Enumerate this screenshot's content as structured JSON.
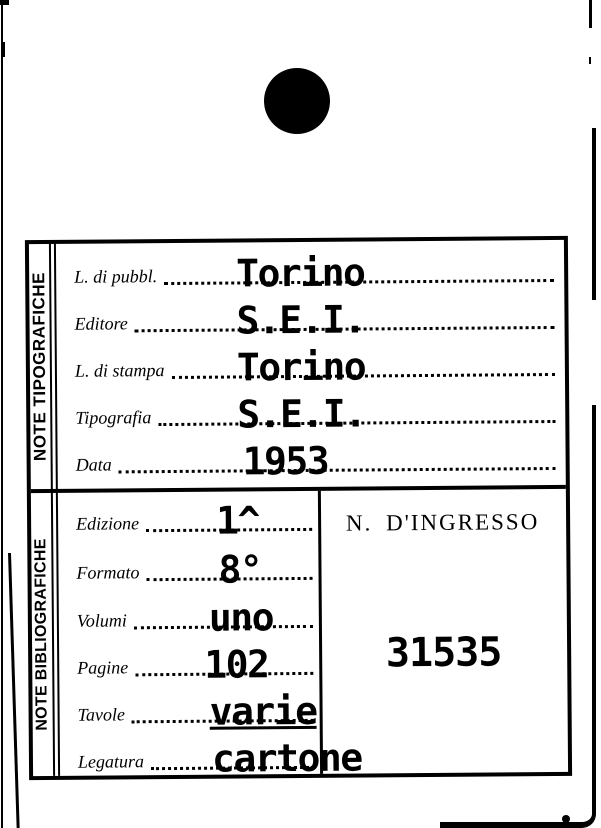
{
  "card": {
    "sections": [
      {
        "side_label": "NOTE TIPOGRAFICHE",
        "fields": [
          {
            "label": "L. di pubbl.",
            "value": "Torino"
          },
          {
            "label": "Editore",
            "value": "S.E.I."
          },
          {
            "label": "L. di stampa",
            "value": "Torino"
          },
          {
            "label": "Tipografia",
            "value": "S.E.I."
          },
          {
            "label": "Data",
            "value": "1953"
          }
        ]
      },
      {
        "side_label": "NOTE BIBLIOGRAFICHE",
        "fields": [
          {
            "label": "Edizione",
            "value": "1^"
          },
          {
            "label": "Formato",
            "value": "8°"
          },
          {
            "label": "Volumi",
            "value": "uno"
          },
          {
            "label": "Pagine",
            "value": "102"
          },
          {
            "label": "Tavole",
            "value": "varie"
          },
          {
            "label": "Legatura",
            "value": "cartone"
          }
        ],
        "ingresso": {
          "label": "N. D'INGRESSO",
          "value": "31535"
        }
      }
    ]
  },
  "colors": {
    "ink": "#000000",
    "paper": "#ffffff"
  }
}
